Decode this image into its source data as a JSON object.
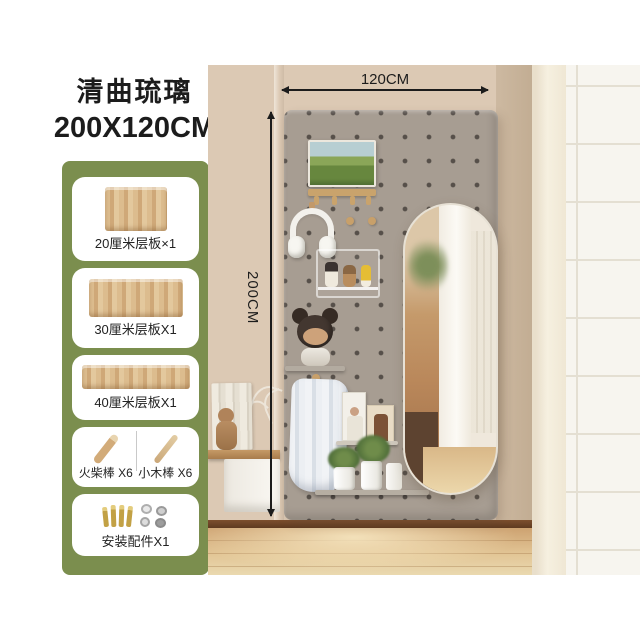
{
  "title": {
    "line1": "清曲琉璃",
    "line2": "200X120CM"
  },
  "dimensions": {
    "width_label": "120CM",
    "height_label": "200CM"
  },
  "components": {
    "items": [
      {
        "label": "20厘米层板×1"
      },
      {
        "label": "30厘米层板X1"
      },
      {
        "label": "40厘米层板X1"
      },
      {
        "label_left": "火柴棒 X6",
        "label_right": "小木棒 X6"
      },
      {
        "label": "安装配件X1"
      }
    ]
  },
  "colors": {
    "panel_green": "#7b8e4e",
    "pegboard_grey": "#a79d92",
    "wall_beige": "#dcc9b4",
    "floor_wood": "#d9b586",
    "annotation_text": "#1c1c1c"
  }
}
